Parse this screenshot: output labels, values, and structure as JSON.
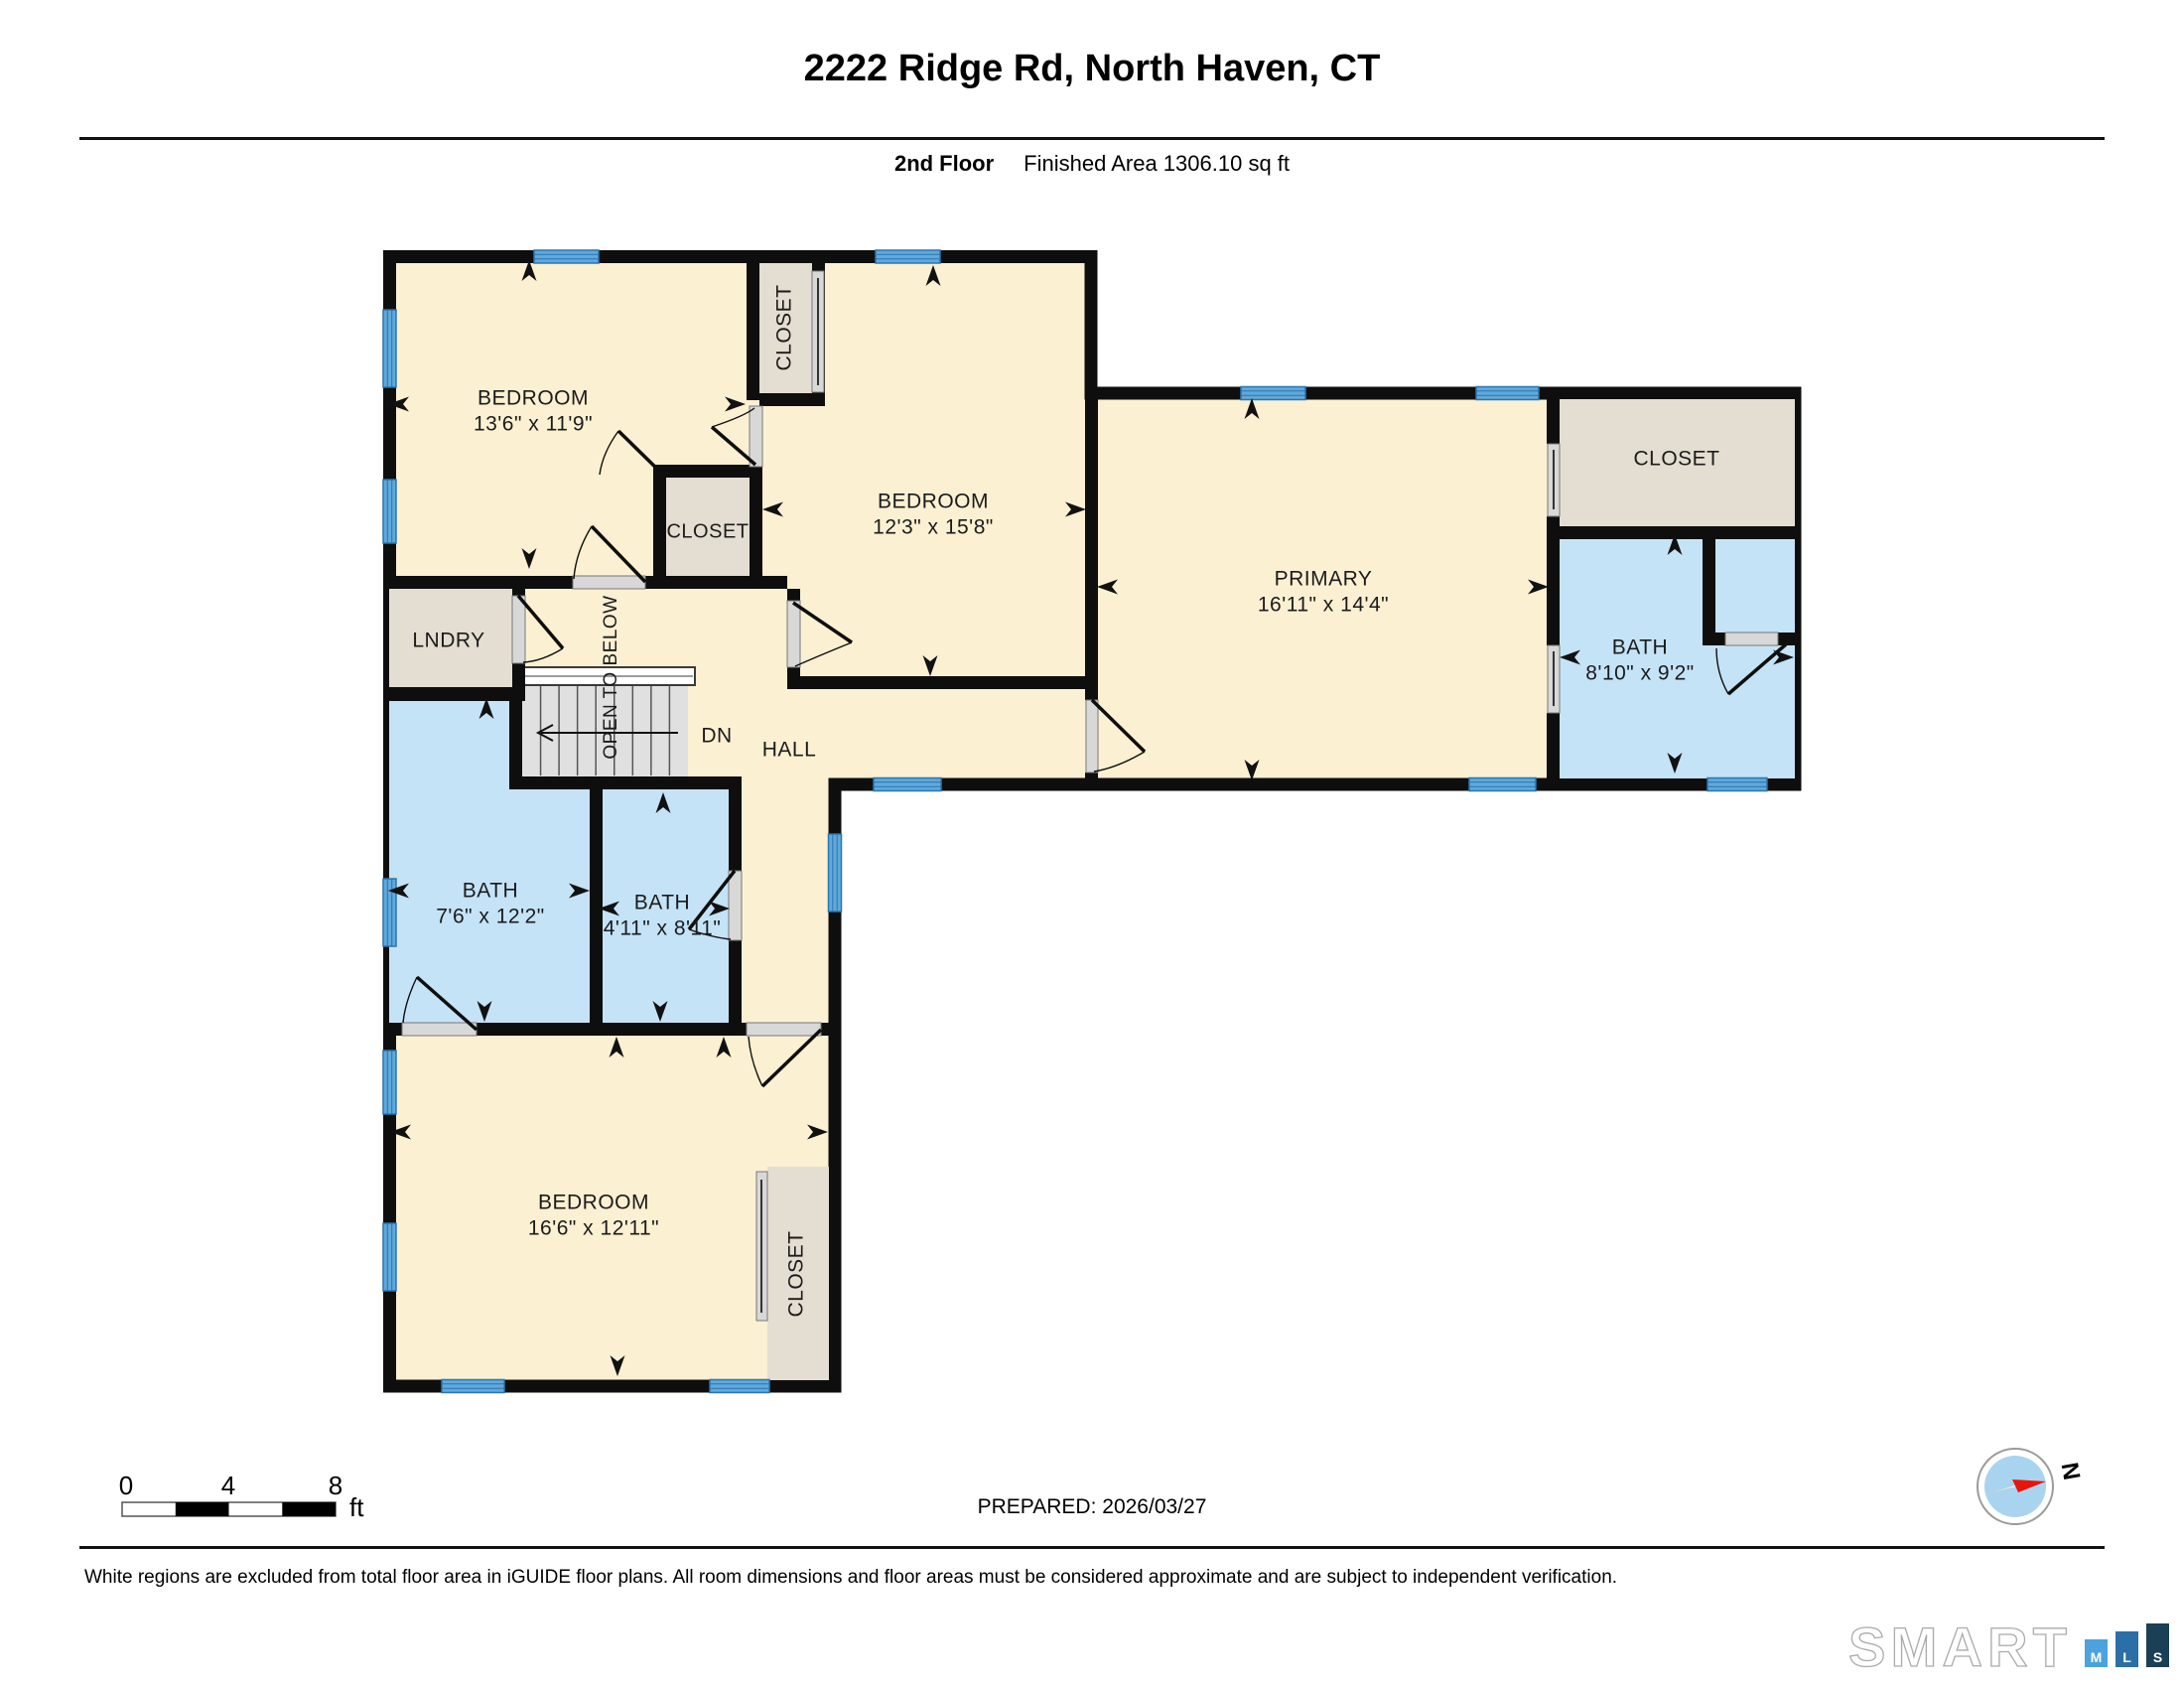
{
  "header": {
    "title": "2222 Ridge Rd, North Haven, CT",
    "floor": "2nd Floor",
    "area": "Finished Area 1306.10 sq ft"
  },
  "plan": {
    "bedroom1": {
      "name": "BEDROOM",
      "dims": "13'6\" x 11'9\""
    },
    "bedroom2": {
      "name": "BEDROOM",
      "dims": "12'3\" x 15'8\""
    },
    "bedroom3": {
      "name": "BEDROOM",
      "dims": "16'6\" x 12'11\""
    },
    "primary": {
      "name": "PRIMARY",
      "dims": "16'11\" x 14'4\""
    },
    "primary_bath": {
      "name": "BATH",
      "dims": "8'10\" x 9'2\""
    },
    "bath_a": {
      "name": "BATH",
      "dims": "7'6\" x 12'2\""
    },
    "bath_b": {
      "name": "BATH",
      "dims": "4'11\" x 8'11\""
    },
    "laundry_label": "LNDRY",
    "hall_label": "HALL",
    "dn_label": "DN",
    "open_below_label": "OPEN TO BELOW",
    "closet_label": "CLOSET"
  },
  "scalebar": {
    "t0": "0",
    "t4": "4",
    "t8": "8",
    "unit": "ft"
  },
  "prepared_label": "PREPARED: 2026/03/27",
  "compass": {
    "north": "N"
  },
  "disclaimer": "White regions are excluded from total floor area in iGUIDE floor plans. All room dimensions and floor areas must be considered approximate and are subject to independent verification.",
  "logo": {
    "brand": "SMART",
    "m": "M",
    "l": "L",
    "s": "S"
  },
  "colors": {
    "room_fill": "#FBF0D2",
    "bath_fill": "#C5E3F7",
    "closet_fill": "#E4DDD1",
    "window_blue": "#5FA9DC",
    "wall": "#0E0E0E",
    "logo_m": "#4BA2DE",
    "logo_l": "#2C6FA6",
    "logo_s": "#1B3F54"
  }
}
